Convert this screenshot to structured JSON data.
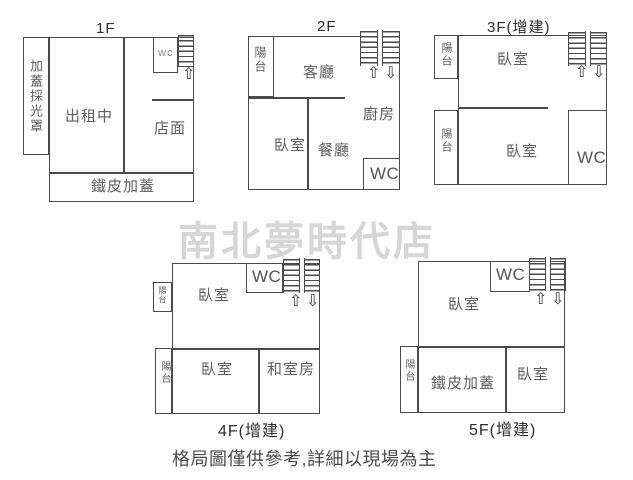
{
  "watermark": "南北夢時代店",
  "caption": "格局圖僅供參考,詳細以現場為主",
  "icons": {
    "up_arrow": "⇧",
    "down_arrow": "⇩",
    "stairs": "stairs-ladder"
  },
  "colors": {
    "line": "#4a4a4a",
    "label": "#5e5e5e",
    "watermark": "#d6d6d6",
    "background": "#fefefe"
  },
  "floors": {
    "f1": {
      "title": "1F",
      "rooms": {
        "skylight": "加蓋採光罩",
        "rental": "出租中",
        "wc": "wc",
        "store": "店面",
        "metal": "鐵皮加蓋"
      }
    },
    "f2": {
      "title": "2F",
      "rooms": {
        "balcony": "陽台",
        "living": "客廳",
        "kitchen": "廚房",
        "bedroom": "臥室",
        "dining": "餐廳",
        "wc": "WC"
      }
    },
    "f3": {
      "title": "3F(增建)",
      "rooms": {
        "balcony_top": "陽台",
        "balcony_bottom": "陽台",
        "bedroom_top": "臥室",
        "bedroom_bottom": "臥室",
        "wc": "WC"
      }
    },
    "f4": {
      "title": "4F(增建)",
      "rooms": {
        "balcony_top": "陽台",
        "balcony_bottom": "陽台",
        "bedroom_top": "臥室",
        "bedroom_bottom": "臥室",
        "tatami": "和室房",
        "wc": "WC"
      }
    },
    "f5": {
      "title": "5F(增建)",
      "rooms": {
        "balcony": "陽台",
        "bedroom_top": "臥室",
        "metal": "鐵皮加蓋",
        "bedroom_bottom": "臥室",
        "wc": "WC"
      }
    }
  }
}
